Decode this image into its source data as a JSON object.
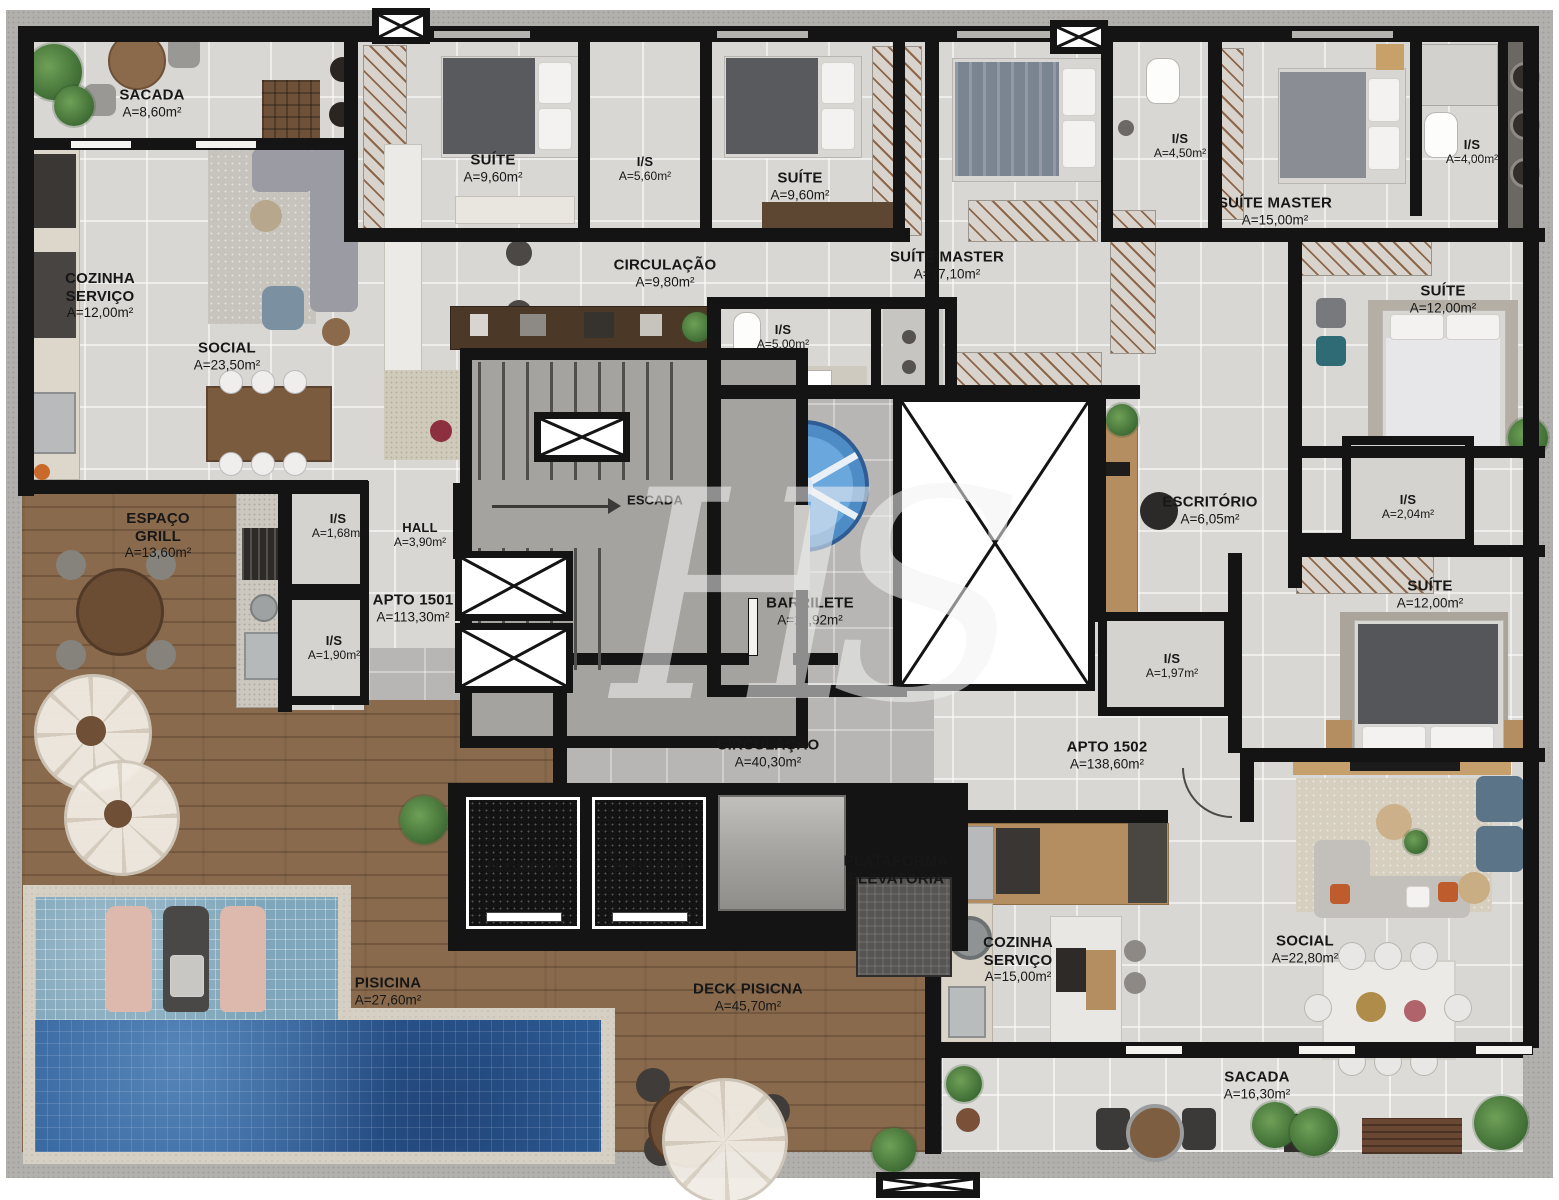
{
  "watermark": "HS",
  "apartments": [
    {
      "id": "apto_1501",
      "label": "APTO 1501",
      "area": "A=113,30m²"
    },
    {
      "id": "apto_1502",
      "label": "APTO 1502",
      "area": "A=138,60m²"
    }
  ],
  "rooms": [
    {
      "id": "sacada_1501",
      "name": "SACADA",
      "area": "A=8,60m²"
    },
    {
      "id": "cozinha_servico_1501",
      "name": "COZINHA SERVIÇO",
      "area": "A=12,00m²"
    },
    {
      "id": "social_1501",
      "name": "SOCIAL",
      "area": "A=23,50m²"
    },
    {
      "id": "suite_1",
      "name": "SUÍTE",
      "area": "A=9,60m²"
    },
    {
      "id": "is_suites",
      "name": "I/S",
      "area": "A=5,60m²"
    },
    {
      "id": "suite_2",
      "name": "SUÍTE",
      "area": "A=9,60m²"
    },
    {
      "id": "circulacao_1501",
      "name": "CIRCULAÇÃO",
      "area": "A=9,80m²"
    },
    {
      "id": "suite_master_1501",
      "name": "SUÍTE MASTER",
      "area": "A=17,10m²"
    },
    {
      "id": "is_master_1501",
      "name": "I/S",
      "area": "A=4,50m²"
    },
    {
      "id": "suite_master_1502",
      "name": "SUÍTE MASTER",
      "area": "A=15,00m²"
    },
    {
      "id": "is_master_1502",
      "name": "I/S",
      "area": "A=4,00m²"
    },
    {
      "id": "suite_3",
      "name": "SUÍTE",
      "area": "A=12,00m²"
    },
    {
      "id": "is_500",
      "name": "I/S",
      "area": "A=5,00m²"
    },
    {
      "id": "escada",
      "name": "ESCADA",
      "area": ""
    },
    {
      "id": "barrilete",
      "name": "BARRILETE",
      "area": "A=11,92m²"
    },
    {
      "id": "escritorio",
      "name": "ESCRITÓRIO",
      "area": "A=6,05m²"
    },
    {
      "id": "is_204",
      "name": "I/S",
      "area": "A=2,04m²"
    },
    {
      "id": "suite_4",
      "name": "SUÍTE",
      "area": "A=12,00m²"
    },
    {
      "id": "espaco_grill",
      "name": "ESPAÇO GRILL",
      "area": "A=13,60m²"
    },
    {
      "id": "is_168",
      "name": "I/S",
      "area": "A=1,68m²"
    },
    {
      "id": "hall",
      "name": "HALL",
      "area": "A=3,90m²"
    },
    {
      "id": "apto_1501",
      "name": "APTO 1501",
      "area": "A=113,30m²"
    },
    {
      "id": "is_190",
      "name": "I/S",
      "area": "A=1,90m²"
    },
    {
      "id": "is_197",
      "name": "I/S",
      "area": "A=1,97m²"
    },
    {
      "id": "circulacao_comum",
      "name": "CIRCULAÇÃO",
      "area": "A=40,30m²"
    },
    {
      "id": "apto_1502",
      "name": "APTO 1502",
      "area": "A=138,60m²"
    },
    {
      "id": "elevador_1",
      "name": "ELEVADOR",
      "area": ""
    },
    {
      "id": "elevador_2",
      "name": "ELEVADOR",
      "area": ""
    },
    {
      "id": "plataforma",
      "name": "PLATAFORMA ELEVATÓRIA",
      "area": ""
    },
    {
      "id": "cozinha_servico_1502",
      "name": "COZINHA SERVIÇO",
      "area": "A=15,00m²"
    },
    {
      "id": "social_1502",
      "name": "SOCIAL",
      "area": "A=22,80m²"
    },
    {
      "id": "pisicina",
      "name": "PISICINA",
      "area": "A=27,60m²"
    },
    {
      "id": "deck_pisicna",
      "name": "DECK PISICNA",
      "area": "A=45,70m²"
    },
    {
      "id": "sacada_1502",
      "name": "SACADA",
      "area": "A=16,30m²"
    }
  ],
  "colors": {
    "wall": "#141414",
    "tile": "#d8d7d4",
    "wood_deck": "#8a6a4c",
    "pool_deep": "#30609a",
    "pool_ledge": "#7fa6ba",
    "water_tank": "#5898cf",
    "accessible_blue": "#3f82c4"
  }
}
